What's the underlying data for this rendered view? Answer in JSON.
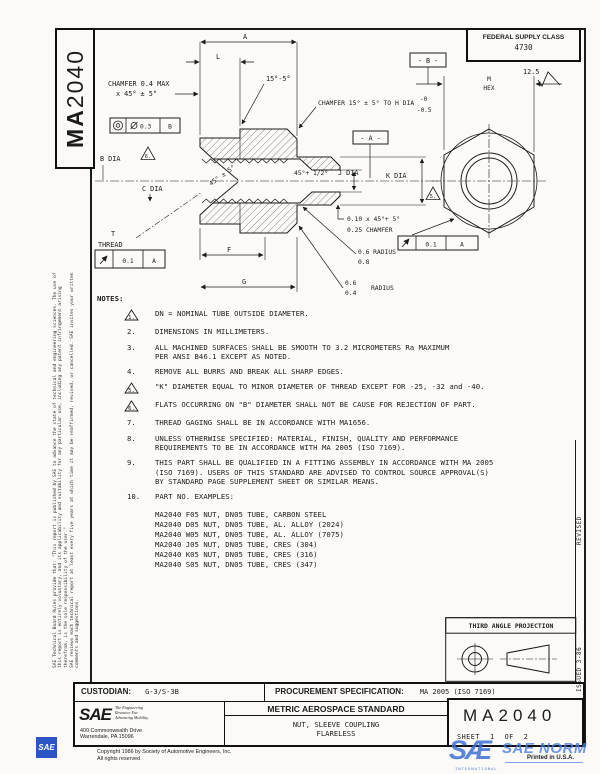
{
  "colors": {
    "ink": "#1c1c1c",
    "watermark_blue": "#3f6fd6"
  },
  "doc_id": {
    "prefix": "MA",
    "number": "2040"
  },
  "fsc": {
    "label": "FEDERAL SUPPLY CLASS",
    "value": "4730"
  },
  "margin": {
    "legal1": "SAE Technical Board Rules provide that: \"This report is published by SAE to advance the state of technical and engineering sciences. The use of this report is entirely voluntary, and its applicability and suitability for any particular use, including any patent infringement arising therefrom, is the sole responsibility of the user.\"",
    "legal2": "SAE reviews each technical report at least every five years at which time it may be reaffirmed, revised, or cancelled. SAE invites your written comments and suggestions.",
    "revised": "REVISED",
    "issued": "ISSUED 3-86"
  },
  "drawing": {
    "dim_a": "A",
    "dim_l": "L",
    "dim_f": "F",
    "dim_g": "G",
    "chamfer_left1": "CHAMFER 0.4 MAX",
    "chamfer_left2": "x 45° ± 5°",
    "angle_15_5": "15°-5°",
    "chamfer_right": "CHAMFER 15° ± 5° TO H DIA",
    "tol_top": "-0",
    "tol_bot": "-0.5",
    "datum_a": "- A -",
    "datum_b": "- B -",
    "hex_m": "M",
    "hex_word": "HEX",
    "finish": "12.5",
    "b_dia": "B DIA",
    "flag6": "6.",
    "c_dia": "C DIA",
    "cone": "45° ± 5°",
    "seat": "45°+ 1/2°",
    "j_dia": "J DIA",
    "k_dia": "K DIA",
    "flag5": "5.",
    "cham_small1": "0.10 x 45°+ 5°",
    "cham_small2": "0.25 CHAMFER",
    "rad1a": "0.6 RADIUS",
    "rad1b": "0.8",
    "rad2a": "0.6",
    "rad2b": "0.4",
    "rad2c": "RADIUS",
    "t": "T",
    "thread": "THREAD",
    "fcf1": {
      "tol": "0.3",
      "datum": "B"
    },
    "fcf2": {
      "tol": "0.1",
      "datum": "A"
    },
    "fcf3": {
      "tol": "0.1",
      "datum": "A"
    }
  },
  "notes": {
    "title": "NOTES:",
    "f1": "1.",
    "n1": "DN = NOMINAL TUBE OUTSIDE DIAMETER.",
    "k2": "2.",
    "n2": "DIMENSIONS IN MILLIMETERS.",
    "k3": "3.",
    "n3a": "ALL MACHINED SURFACES SHALL BE SMOOTH TO 3.2 MICROMETERS Ra MAXIMUM",
    "n3b": "PER ANSI B46.1 EXCEPT AS NOTED.",
    "k4": "4.",
    "n4": "REMOVE ALL BURRS AND BREAK ALL SHARP EDGES.",
    "f5": "5.",
    "n5": "\"K\" DIAMETER EQUAL TO MINOR DIAMETER OF THREAD EXCEPT FOR -25, -32 and -40.",
    "f6": "6.",
    "n6": "FLATS OCCURRING ON \"B\" DIAMETER SHALL NOT BE CAUSE FOR REJECTION OF PART.",
    "k7": "7.",
    "n7": "THREAD GAGING SHALL BE IN ACCORDANCE WITH MA1656.",
    "k8": "8.",
    "n8a": "UNLESS OTHERWISE SPECIFIED: MATERIAL, FINISH, QUALITY AND PERFORMANCE",
    "n8b": "REQUIREMENTS TO BE IN ACCORDANCE WITH MA 2005 (ISO 7169).",
    "k9": "9.",
    "n9a": "THIS PART SHALL BE QUALIFIED IN A FITTING ASSEMBLY IN ACCORDANCE WITH MA 2005",
    "n9b": "(ISO 7169).  USERS OF THIS STANDARD ARE ADVISED TO CONTROL SOURCE APPROVAL(S)",
    "n9c": "BY STANDARD PAGE SUPPLEMENT SHEET OR SIMILAR MEANS.",
    "k10": "10.",
    "n10": "PART NO. EXAMPLES:",
    "ex1": "MA2040 F05 NUT, DN05 TUBE, CARBON STEEL",
    "ex2": "MA2040 D05 NUT, DN05 TUBE, AL. ALLOY (2024)",
    "ex3": "MA2040 W05 NUT, DN05 TUBE, AL. ALLOY (7075)",
    "ex4": "MA2040 J05 NUT, DN05 TUBE, CRES (304)",
    "ex5": "MA2040 K05 NUT, DN05 TUBE, CRES (316)",
    "ex6": "MA2040 S05 NUT, DN05 TUBE, CRES (347)"
  },
  "projection": {
    "label": "THIRD ANGLE PROJECTION"
  },
  "titleblock": {
    "custodian_label": "CUSTODIAN:",
    "custodian_value": "G-3/S-3B",
    "procurement_label": "PROCUREMENT SPECIFICATION:",
    "procurement_value": "MA 2005 (ISO 7169)",
    "standard": "METRIC AEROSPACE STANDARD",
    "part_title1": "NUT, SLEEVE COUPLING",
    "part_title2": "FLARELESS",
    "doc_number": "MA2040",
    "sheet": "SHEET",
    "sheet_no": "1",
    "of": "OF",
    "sheet_total": "2",
    "sae_logo": "SAE",
    "tag1": "The Engineering",
    "tag2": "Resource For",
    "tag3": "Advancing Mobility.",
    "addr1": "400 Commonwealth Drive",
    "addr2": "Warrendale, PA 15096",
    "copyright": "Copyright 1986 by Society of Automotive Engineers, Inc.",
    "rights": "All rights reserved"
  },
  "watermark": {
    "sae": "SÆ",
    "norm": "SAE NORM",
    "intl": "INTERNATIONAL",
    "printed": "Printed in U.S.A.",
    "corner": "SAE"
  }
}
